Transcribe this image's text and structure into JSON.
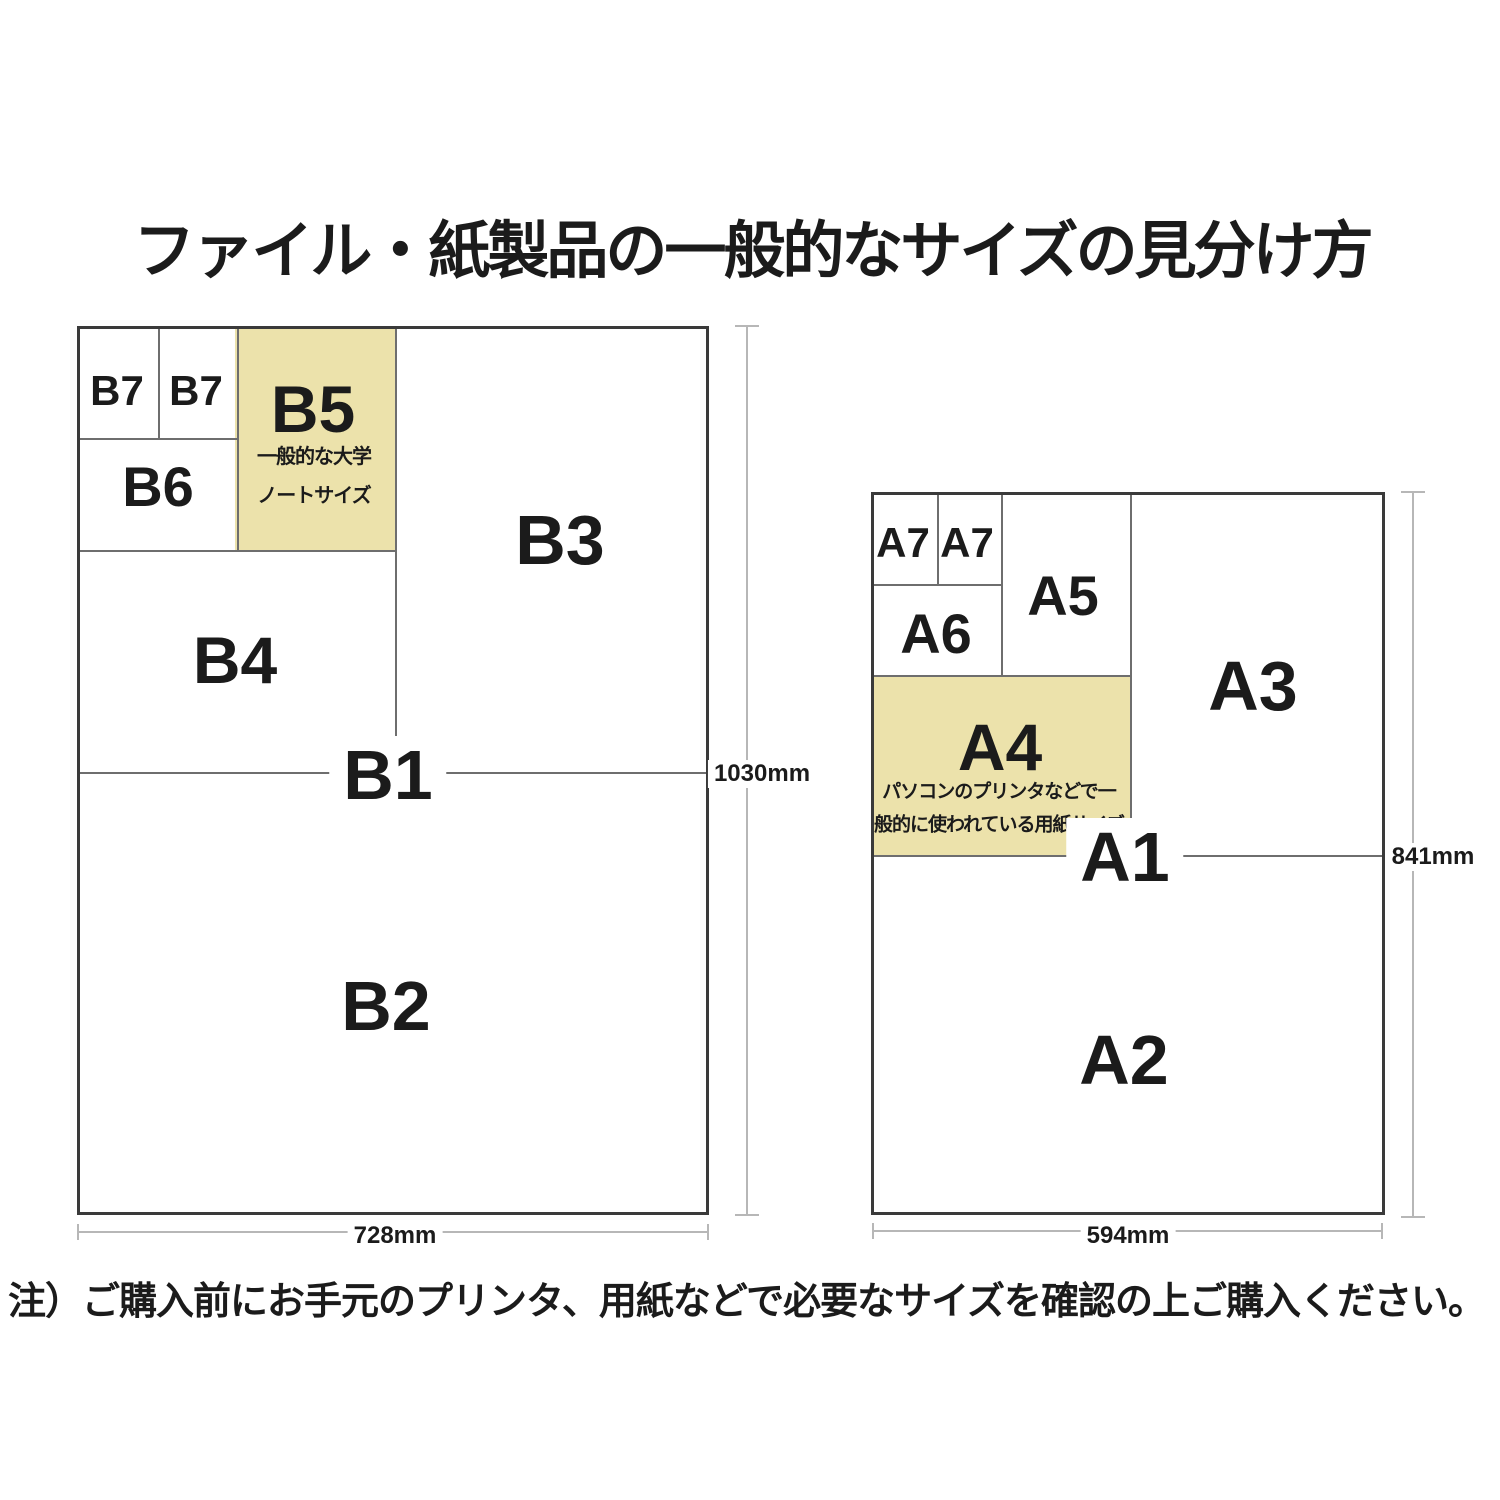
{
  "title": "ファイル・紙製品の一般的なサイズの見分け方",
  "footnote": "注）ご購入前にお手元のプリンタ、用紙などで必要なサイズを確認の上ご購入ください。",
  "colors": {
    "highlight_fill": "#ECE2AB",
    "outer_line": "#3A3A3A",
    "inner_line": "#6E6E6E",
    "dimension_line": "#B7B7B7",
    "text": "#1B1B1B"
  },
  "b_series": {
    "labels": {
      "b7_left": "B7",
      "b7_right": "B7",
      "b6": "B6",
      "b5": "B5",
      "b4": "B4",
      "b3": "B3",
      "b2": "B2",
      "b1": "B1"
    },
    "b5_note_line1": "一般的な大学",
    "b5_note_line2": "ノートサイズ",
    "height_dim": "1030mm",
    "width_dim": "728mm"
  },
  "a_series": {
    "labels": {
      "a7_left": "A7",
      "a7_right": "A7",
      "a6": "A6",
      "a5": "A5",
      "a4": "A4",
      "a3": "A3",
      "a2": "A2",
      "a1": "A1"
    },
    "a4_note_line1": "パソコンのプリンタなどで一",
    "a4_note_line2": "般的に使われている用紙サイズ",
    "height_dim": "841mm",
    "width_dim": "594mm"
  }
}
